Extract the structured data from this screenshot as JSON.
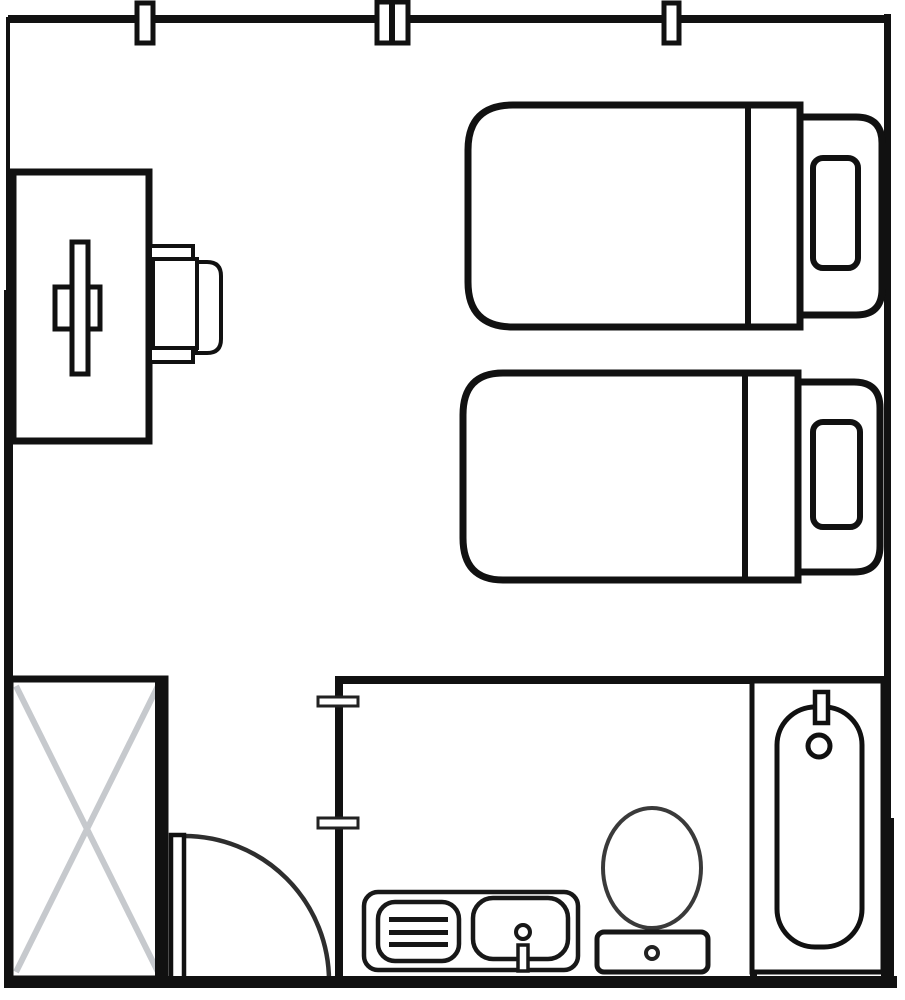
{
  "canvas": {
    "width": 905,
    "height": 1000,
    "background": "#ffffff"
  },
  "colors": {
    "ink": "#111111",
    "soft_ink": "#2e2e2e",
    "fixture_ink": "#3a3a3a",
    "wardrobe_cross": "#c6c9cd",
    "fill": "#ffffff"
  },
  "legend": {
    "diagram_type": "room-floor-plan",
    "areas": [
      "bedroom",
      "bathroom"
    ],
    "furniture": [
      "desk",
      "desk-chair",
      "bed",
      "bed",
      "wardrobe",
      "door",
      "sink-vanity",
      "toilet",
      "bathtub"
    ]
  },
  "shapes": [
    {
      "name": "top-wall",
      "type": "rect",
      "attrs": {
        "x": 8,
        "y": 15,
        "width": 881,
        "height": 8,
        "fill": "#111111"
      }
    },
    {
      "name": "left-wall-upper",
      "type": "rect",
      "attrs": {
        "x": 6,
        "y": 17,
        "width": 4,
        "height": 276,
        "fill": "#111111"
      }
    },
    {
      "name": "left-wall-lower",
      "type": "rect",
      "attrs": {
        "x": 4,
        "y": 290,
        "width": 9,
        "height": 698,
        "fill": "#111111"
      }
    },
    {
      "name": "right-wall",
      "type": "rect",
      "attrs": {
        "x": 884,
        "y": 14,
        "width": 7,
        "height": 966,
        "fill": "#111111"
      }
    },
    {
      "name": "right-wall-lower-patch",
      "type": "rect",
      "attrs": {
        "x": 881,
        "y": 818,
        "width": 13,
        "height": 170,
        "fill": "#111111"
      }
    },
    {
      "name": "window-marker-left",
      "type": "rect",
      "attrs": {
        "x": 137,
        "y": 3,
        "width": 16,
        "height": 40,
        "fill": "#ffffff",
        "stroke": "#111111",
        "stroke-width": 5
      }
    },
    {
      "name": "window-marker-middle",
      "type": "rect",
      "attrs": {
        "x": 377,
        "y": 2,
        "width": 31,
        "height": 41,
        "fill": "#ffffff",
        "stroke": "#111111",
        "stroke-width": 5
      }
    },
    {
      "name": "window-marker-middle-mullion",
      "type": "rect",
      "attrs": {
        "x": 389,
        "y": 2,
        "width": 6,
        "height": 41,
        "fill": "#111111"
      }
    },
    {
      "name": "window-marker-right",
      "type": "rect",
      "attrs": {
        "x": 664,
        "y": 3,
        "width": 15,
        "height": 40,
        "fill": "#ffffff",
        "stroke": "#111111",
        "stroke-width": 5
      }
    },
    {
      "name": "desk",
      "type": "rect",
      "attrs": {
        "x": 13,
        "y": 172,
        "width": 136,
        "height": 269,
        "fill": "#ffffff",
        "stroke": "#111111",
        "stroke-width": 7
      }
    },
    {
      "name": "desk-cross-horizontal",
      "type": "rect",
      "attrs": {
        "x": 55,
        "y": 287,
        "width": 45,
        "height": 42,
        "fill": "#ffffff",
        "stroke": "#111111",
        "stroke-width": 5
      }
    },
    {
      "name": "desk-cross-vertical",
      "type": "rect",
      "attrs": {
        "x": 72,
        "y": 242,
        "width": 16,
        "height": 132,
        "fill": "#ffffff",
        "stroke": "#111111",
        "stroke-width": 5
      }
    },
    {
      "name": "chair-backrest",
      "type": "path",
      "attrs": {
        "d": "M 196 262 L 207 262 Q 221 262 221 276 L 221 339 Q 221 353 207 353 L 196 353 Z",
        "fill": "#ffffff",
        "stroke": "#111111",
        "stroke-width": 4
      }
    },
    {
      "name": "chair-armrest-top",
      "type": "rect",
      "attrs": {
        "x": 150,
        "y": 246,
        "width": 43,
        "height": 14,
        "fill": "#ffffff",
        "stroke": "#111111",
        "stroke-width": 4
      }
    },
    {
      "name": "chair-armrest-bottom",
      "type": "rect",
      "attrs": {
        "x": 150,
        "y": 346,
        "width": 43,
        "height": 16,
        "fill": "#ffffff",
        "stroke": "#111111",
        "stroke-width": 4
      }
    },
    {
      "name": "chair-seat",
      "type": "rect",
      "attrs": {
        "x": 153,
        "y": 259,
        "width": 44,
        "height": 89,
        "fill": "#ffffff",
        "stroke": "#111111",
        "stroke-width": 4
      }
    },
    {
      "name": "bed-1-body",
      "type": "path",
      "attrs": {
        "d": "M 800 105 L 513 105 Q 468 105 468 150 L 468 282 Q 468 327 513 327 L 800 327 Z",
        "fill": "#ffffff",
        "stroke": "#111111",
        "stroke-width": 7
      }
    },
    {
      "name": "bed-1-fold-line",
      "type": "line",
      "attrs": {
        "x1": 748,
        "y1": 105,
        "x2": 748,
        "y2": 327,
        "stroke": "#111111",
        "stroke-width": 6
      }
    },
    {
      "name": "bed-1-headboard",
      "type": "path",
      "attrs": {
        "d": "M 800 117 L 856 117 Q 882 117 882 143 L 882 289 Q 882 315 856 315 L 800 315 Z",
        "fill": "#ffffff",
        "stroke": "#111111",
        "stroke-width": 7
      }
    },
    {
      "name": "bed-1-pillow",
      "type": "rect",
      "attrs": {
        "x": 813,
        "y": 158,
        "width": 45,
        "height": 110,
        "rx": 10,
        "fill": "#ffffff",
        "stroke": "#111111",
        "stroke-width": 6
      }
    },
    {
      "name": "bed-2-body",
      "type": "path",
      "attrs": {
        "d": "M 798 373 L 503 373 Q 463 373 463 415 L 463 538 Q 463 580 503 580 L 798 580 Z",
        "fill": "#ffffff",
        "stroke": "#111111",
        "stroke-width": 7
      }
    },
    {
      "name": "bed-2-fold-line",
      "type": "line",
      "attrs": {
        "x1": 745,
        "y1": 373,
        "x2": 745,
        "y2": 580,
        "stroke": "#111111",
        "stroke-width": 6
      }
    },
    {
      "name": "bed-2-headboard",
      "type": "path",
      "attrs": {
        "d": "M 798 382 L 854 382 Q 880 382 880 408 L 880 546 Q 880 572 854 572 L 798 572 Z",
        "fill": "#ffffff",
        "stroke": "#111111",
        "stroke-width": 7
      }
    },
    {
      "name": "bed-2-pillow",
      "type": "rect",
      "attrs": {
        "x": 813,
        "y": 422,
        "width": 47,
        "height": 105,
        "rx": 10,
        "fill": "#ffffff",
        "stroke": "#111111",
        "stroke-width": 6
      }
    },
    {
      "name": "wardrobe-body",
      "type": "rect",
      "attrs": {
        "x": 10,
        "y": 679,
        "width": 155,
        "height": 300,
        "fill": "#ffffff",
        "stroke": "#111111",
        "stroke-width": 7
      }
    },
    {
      "name": "wardrobe-cross-line-1",
      "type": "line",
      "attrs": {
        "x1": 16,
        "y1": 686,
        "x2": 158,
        "y2": 972,
        "stroke": "#c6c9cd",
        "stroke-width": 6
      }
    },
    {
      "name": "wardrobe-cross-line-2",
      "type": "line",
      "attrs": {
        "x1": 158,
        "y1": 686,
        "x2": 16,
        "y2": 972,
        "stroke": "#c6c9cd",
        "stroke-width": 6
      }
    },
    {
      "name": "wardrobe-right-edge",
      "type": "rect",
      "attrs": {
        "x": 155,
        "y": 678,
        "width": 11,
        "height": 302,
        "fill": "#111111"
      }
    },
    {
      "name": "bathroom-top-wall",
      "type": "rect",
      "attrs": {
        "x": 335,
        "y": 676,
        "width": 549,
        "height": 8,
        "fill": "#111111"
      }
    },
    {
      "name": "bathroom-left-wall",
      "type": "rect",
      "attrs": {
        "x": 335,
        "y": 676,
        "width": 8,
        "height": 312,
        "fill": "#111111"
      }
    },
    {
      "name": "bathroom-divider-wall",
      "type": "rect",
      "attrs": {
        "x": 750,
        "y": 681,
        "width": 7,
        "height": 307,
        "fill": "#111111"
      }
    },
    {
      "name": "wall-opening-tick-top",
      "type": "rect",
      "attrs": {
        "x": 318,
        "y": 697,
        "width": 40,
        "height": 9,
        "fill": "#ffffff",
        "stroke": "#222222",
        "stroke-width": 3
      }
    },
    {
      "name": "wall-opening-tick-bottom",
      "type": "rect",
      "attrs": {
        "x": 318,
        "y": 818,
        "width": 40,
        "height": 10,
        "fill": "#ffffff",
        "stroke": "#222222",
        "stroke-width": 3
      }
    },
    {
      "name": "door-swing-arc",
      "type": "path",
      "attrs": {
        "d": "M 184 836 A 145 145 0 0 1 329 981",
        "fill": "none",
        "stroke": "#2e2e2e",
        "stroke-width": 4.5
      }
    },
    {
      "name": "door-leaf",
      "type": "rect",
      "attrs": {
        "x": 171,
        "y": 835,
        "width": 13,
        "height": 145,
        "fill": "#ffffff",
        "stroke": "#111111",
        "stroke-width": 4.5
      }
    },
    {
      "name": "vanity-counter",
      "type": "rect",
      "attrs": {
        "x": 364,
        "y": 892,
        "width": 214,
        "height": 78,
        "rx": 14,
        "fill": "#ffffff",
        "stroke": "#181818",
        "stroke-width": 4.5
      }
    },
    {
      "name": "vanity-basin-left",
      "type": "rect",
      "attrs": {
        "x": 378,
        "y": 902,
        "width": 81,
        "height": 59,
        "rx": 17,
        "fill": "#ffffff",
        "stroke": "#181818",
        "stroke-width": 4.5
      }
    },
    {
      "name": "vanity-grate-bar-1",
      "type": "rect",
      "attrs": {
        "x": 389,
        "y": 917,
        "width": 59,
        "height": 5,
        "fill": "#161616"
      }
    },
    {
      "name": "vanity-grate-bar-2",
      "type": "rect",
      "attrs": {
        "x": 389,
        "y": 930,
        "width": 59,
        "height": 5,
        "fill": "#161616"
      }
    },
    {
      "name": "vanity-grate-bar-3",
      "type": "rect",
      "attrs": {
        "x": 389,
        "y": 942,
        "width": 59,
        "height": 5,
        "fill": "#161616"
      }
    },
    {
      "name": "vanity-basin-right",
      "type": "rect",
      "attrs": {
        "x": 473,
        "y": 898,
        "width": 95,
        "height": 61,
        "rx": 20,
        "fill": "#ffffff",
        "stroke": "#181818",
        "stroke-width": 4.5
      }
    },
    {
      "name": "vanity-faucet-circle",
      "type": "circle",
      "attrs": {
        "cx": 523,
        "cy": 932,
        "r": 7,
        "fill": "#ffffff",
        "stroke": "#181818",
        "stroke-width": 4
      }
    },
    {
      "name": "vanity-faucet-handle",
      "type": "rect",
      "attrs": {
        "x": 518,
        "y": 945,
        "width": 10,
        "height": 26,
        "fill": "#ffffff",
        "stroke": "#181818",
        "stroke-width": 3.5
      }
    },
    {
      "name": "toilet-bowl",
      "type": "ellipse",
      "attrs": {
        "cx": 652,
        "cy": 868,
        "rx": 49,
        "ry": 60,
        "fill": "#ffffff",
        "stroke": "#3a3a3a",
        "stroke-width": 4
      }
    },
    {
      "name": "toilet-tank",
      "type": "rect",
      "attrs": {
        "x": 597,
        "y": 932,
        "width": 111,
        "height": 40,
        "rx": 7,
        "fill": "#ffffff",
        "stroke": "#161616",
        "stroke-width": 5
      }
    },
    {
      "name": "toilet-flush-button",
      "type": "circle",
      "attrs": {
        "cx": 652,
        "cy": 953,
        "r": 6,
        "fill": "#ffffff",
        "stroke": "#222222",
        "stroke-width": 4
      }
    },
    {
      "name": "bathtub-surround",
      "type": "rect",
      "attrs": {
        "x": 752,
        "y": 681,
        "width": 131,
        "height": 291,
        "fill": "#ffffff",
        "stroke": "#111111",
        "stroke-width": 5
      }
    },
    {
      "name": "bathtub-basin",
      "type": "rect",
      "attrs": {
        "x": 777,
        "y": 707,
        "width": 85,
        "height": 240,
        "rx": 38,
        "fill": "#ffffff",
        "stroke": "#111111",
        "stroke-width": 5
      }
    },
    {
      "name": "bathtub-tap",
      "type": "rect",
      "attrs": {
        "x": 815,
        "y": 692,
        "width": 13,
        "height": 31,
        "fill": "#ffffff",
        "stroke": "#111111",
        "stroke-width": 4.5
      }
    },
    {
      "name": "bathtub-drain",
      "type": "circle",
      "attrs": {
        "cx": 819,
        "cy": 746,
        "r": 11,
        "fill": "#ffffff",
        "stroke": "#111111",
        "stroke-width": 5
      }
    },
    {
      "name": "bottom-wall",
      "type": "rect",
      "attrs": {
        "x": 4,
        "y": 976,
        "width": 893,
        "height": 12,
        "fill": "#111111"
      }
    }
  ]
}
